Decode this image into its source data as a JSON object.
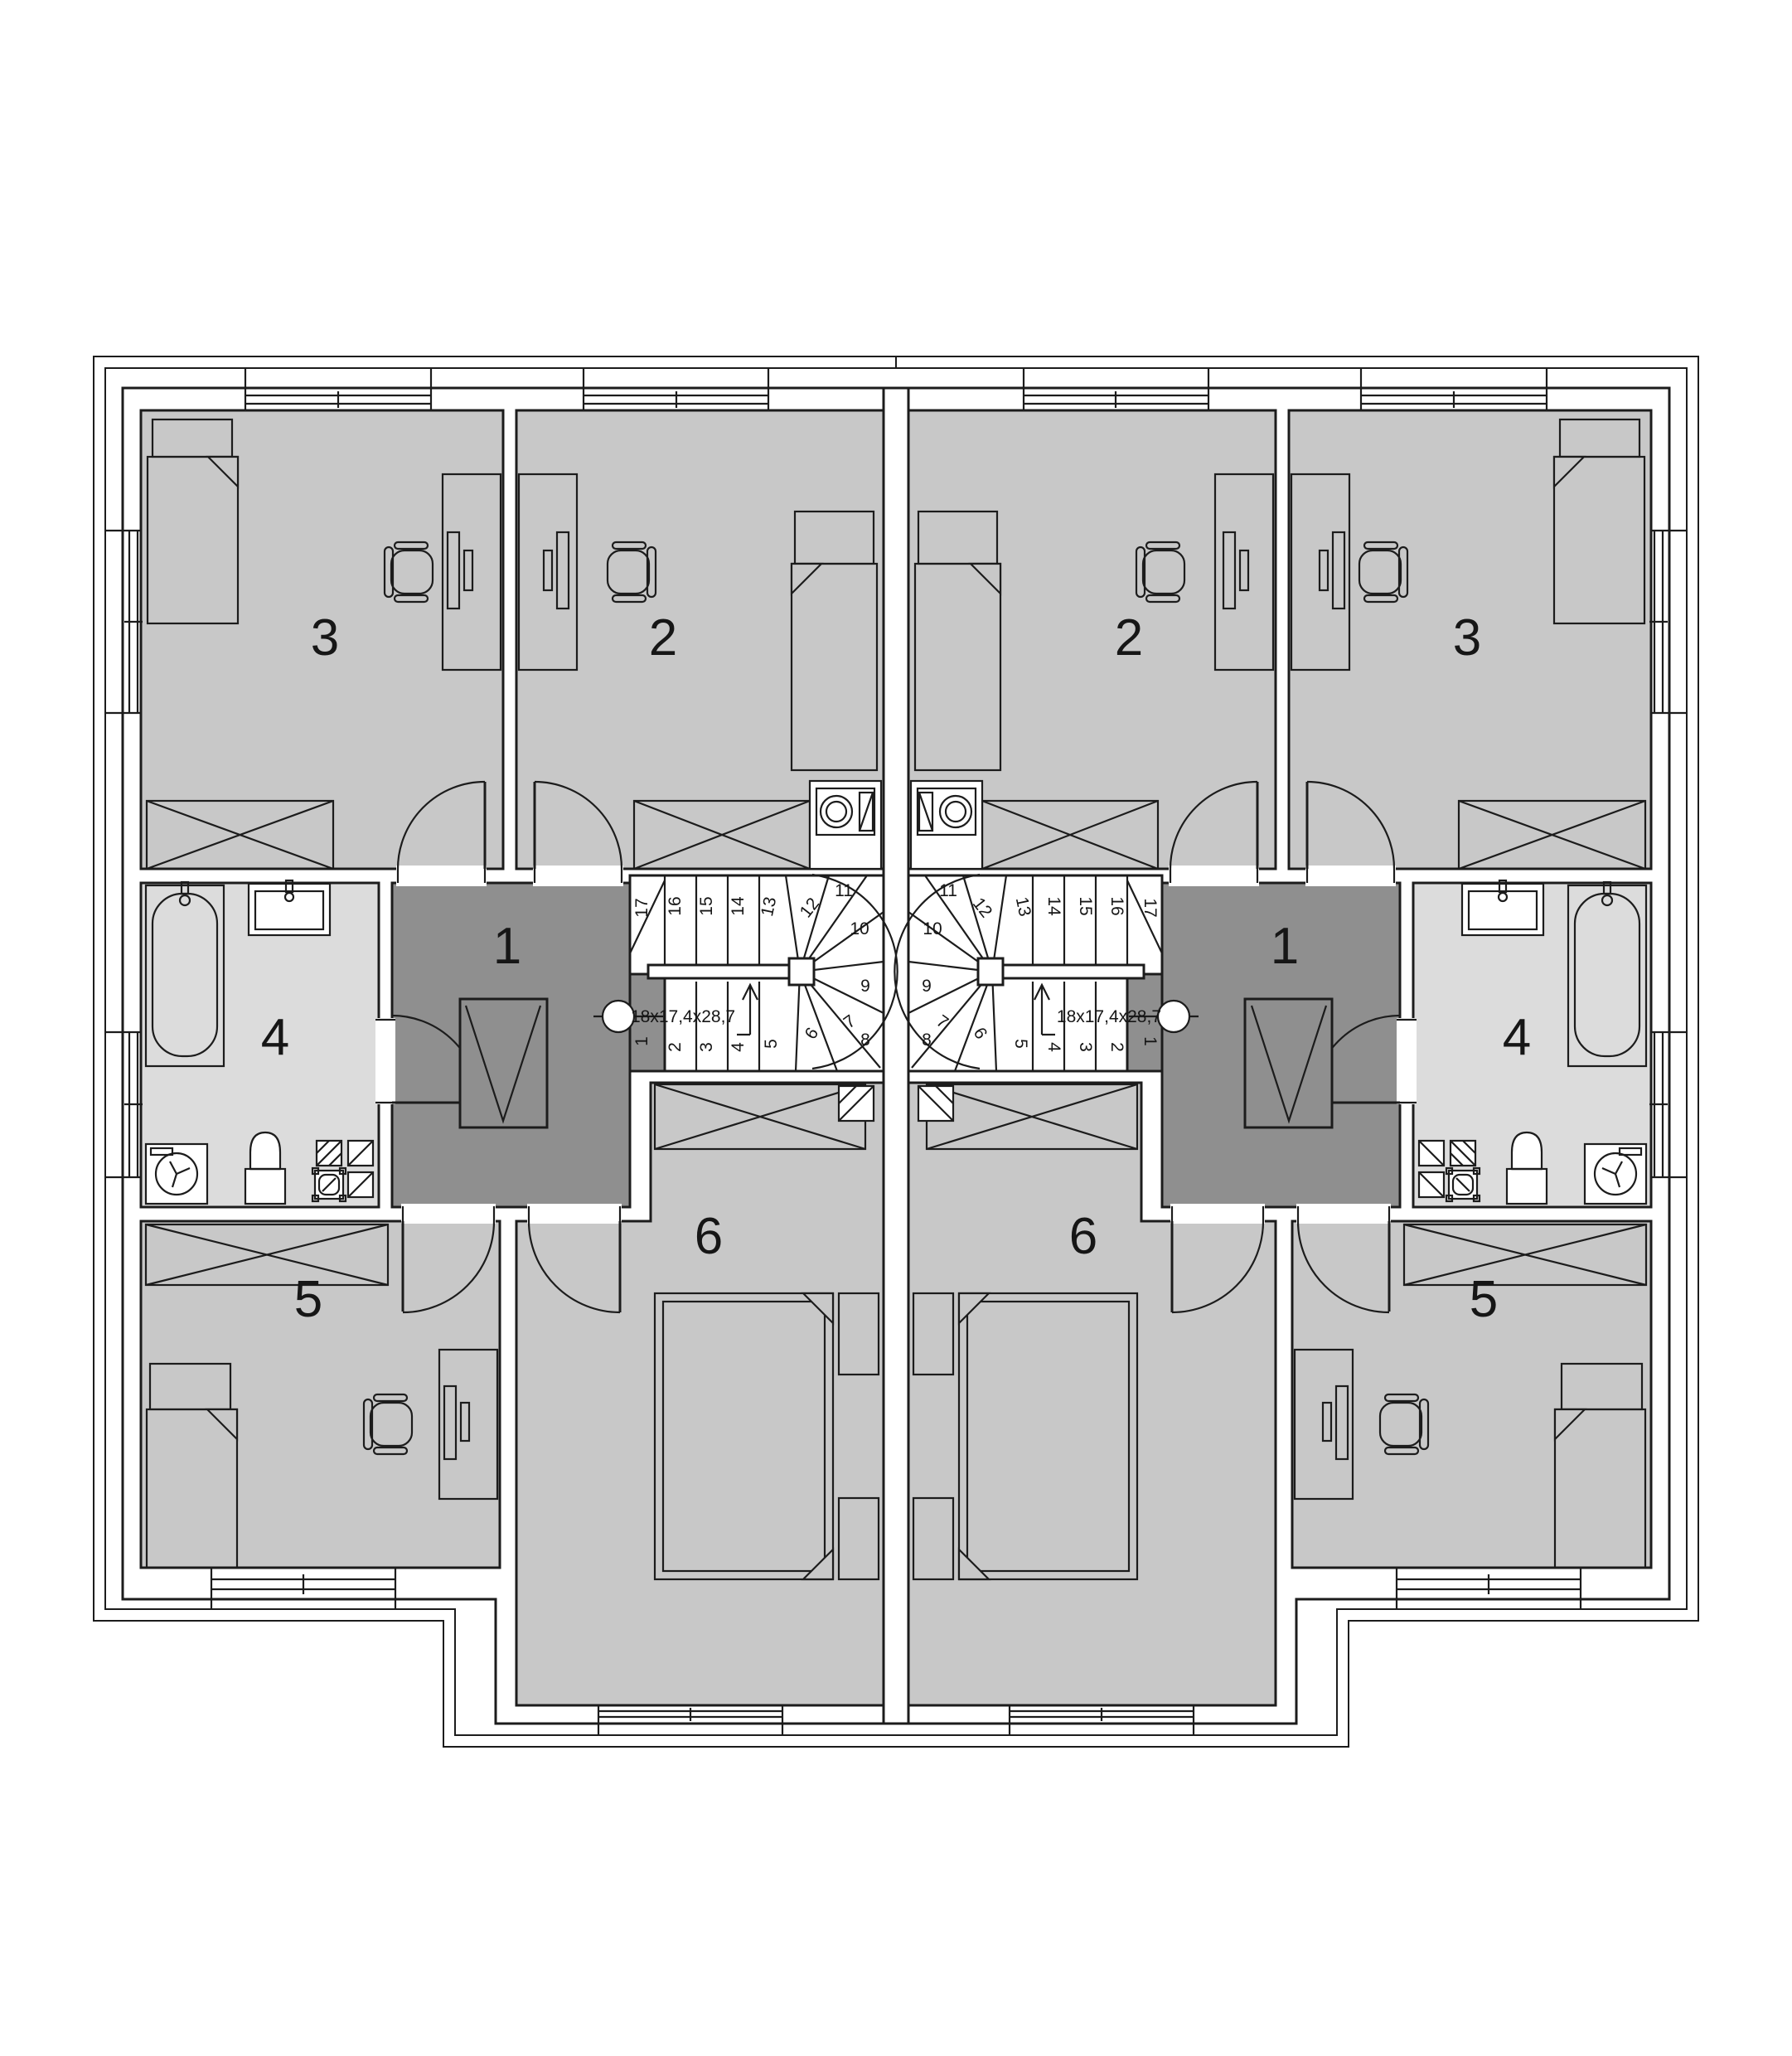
{
  "plan": {
    "type": "duplex-upper-floor-plan",
    "room_numbers": {
      "r1": "1",
      "r2": "2",
      "r3": "3",
      "r4": "4",
      "r5": "5",
      "r6": "6"
    },
    "stair": {
      "dimension_label": "18x17,4x28,7",
      "step_numbers": [
        "1",
        "2",
        "3",
        "4",
        "5",
        "6",
        "7",
        "8",
        "9",
        "10",
        "11",
        "12",
        "13",
        "14",
        "15",
        "16",
        "17"
      ]
    },
    "colors": {
      "paper": "#ffffff",
      "floor": "#c8c8c8",
      "bathroom": "#dcdcdc",
      "hall": "#8f8f8f",
      "line": "#1c1c1c",
      "fixture": "#ffffff"
    }
  }
}
